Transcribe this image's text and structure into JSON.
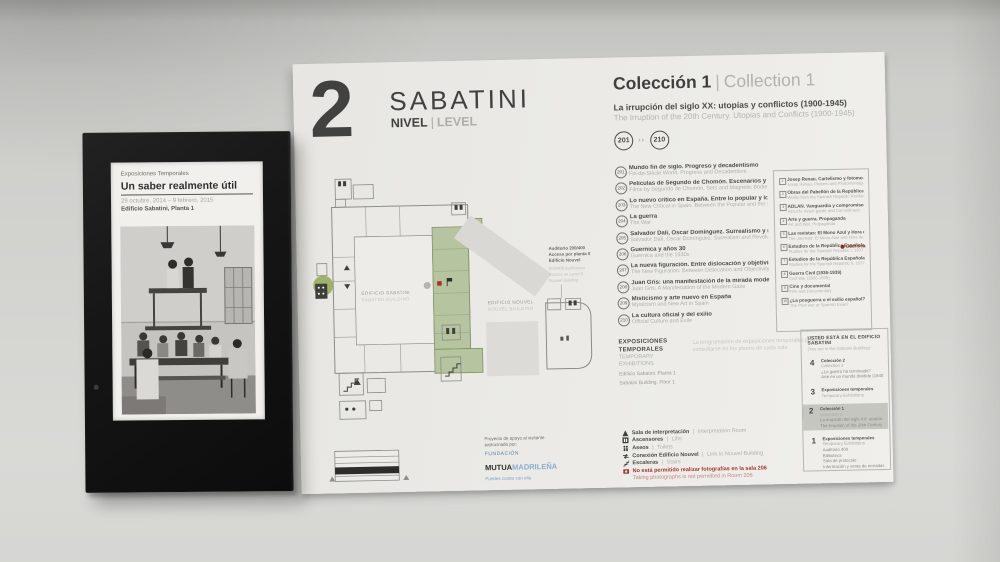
{
  "kiosk": {
    "eyebrow": "Exposiciones Temporales",
    "title": "Un saber realmente útil",
    "dates": "29 octubre, 2014 – 9 febrero, 2015",
    "location": "Edificio Sabatini, Planta 1"
  },
  "header": {
    "level_number": "2",
    "building_name": "SABATINI",
    "level_es": "NIVEL",
    "divider": "|",
    "level_en": "LEVEL"
  },
  "collection": {
    "title_es": "Colección 1",
    "divider": "|",
    "title_en": "Collection 1",
    "subtitle_es": "La irrupción del siglo XX: utopías y conflictos (1900-1945)",
    "subtitle_en": "The Irruption of the 20th Century. Utopias and Conflicts (1900-1945)",
    "room_start": "201",
    "room_end": "210",
    "range_separator": "››"
  },
  "rooms": [
    {
      "num": "201",
      "es": "Mundo fin de siglo. Progreso y decadentismo",
      "en": "Fin-de-Siècle World. Progress and Decadentism"
    },
    {
      "num": "202",
      "es": "Películas de Segundo de Chomón. Escenarios y cuerpos magnéticos",
      "en": "Films by Segundo de Chomón. Sets and Magnetic Bodies"
    },
    {
      "num": "203",
      "es": "Lo nuevo crítico en España. Entre lo popular y lo moderno",
      "en": "The New Critical in Spain. Between the Popular and the Modern"
    },
    {
      "num": "204",
      "es": "La guerra",
      "en": "The War"
    },
    {
      "num": "205",
      "es": "Salvador Dalí, Óscar Domínguez. Surrealismo y revolución",
      "en": "Salvador Dalí, Óscar Domínguez. Surrealism and Revolution"
    },
    {
      "num": "206",
      "es": "Guernica y años 30",
      "en": "Guernica and the 1930s"
    },
    {
      "num": "207",
      "es": "La nueva figuración. Entre dislocación y objetividad",
      "en": "The New Figuration. Between Dislocation and Objectivity"
    },
    {
      "num": "208",
      "es": "Juan Gris: una manifestación de la mirada moderna",
      "en": "Juan Gris: A Manifestation of the Modern Gaze"
    },
    {
      "num": "209",
      "es": "Misticismo y arte nuevo en España",
      "en": "Mysticism and New Art in Spain"
    },
    {
      "num": "210",
      "es": "La cultura oficial y del exilio",
      "en": "Official Culture and Exile"
    }
  ],
  "highlights": {
    "items": [
      {
        "num": "1",
        "es": "Josep Renau. Cartelismo y fotomontaje",
        "en": "Josep Renau. Posters and Photomontage"
      },
      {
        "num": "2",
        "es": "Obras del Pabellón de la República Española, 1937",
        "en": "Works from the Spanish Republic Pavilion, 1937"
      },
      {
        "num": "3",
        "es": "ADLAN. Vanguardia y compromiso",
        "en": "ADLAN. Avant-garde and Commitment"
      },
      {
        "num": "4",
        "es": "Arte y guerra. Propaganda",
        "en": "Art and War. Propaganda"
      },
      {
        "num": "5",
        "es": "Las revistas: El Mono Azul y Hora de España",
        "en": "The Journals: El Mono Azul and Hora de España"
      },
      {
        "num": "6",
        "es": "Estudios de la República Española I, 1937",
        "en": "Studies for the Spanish Republic I, 1937"
      },
      {
        "num": "7",
        "es": "Estudios de la República Española II, 1937",
        "en": "Studies for the Spanish Republic II, 1937"
      },
      {
        "num": "8",
        "es": "Guerra Civil (1936-1939)",
        "en": "Civil War (1936-1939)"
      },
      {
        "num": "9",
        "es": "Cine y documental",
        "en": "Film and Documentary"
      },
      {
        "num": "10",
        "es": "¿La posguerra o el exilio español?",
        "en": "The Post-war or Spanish Exile?"
      }
    ],
    "marker_label": "Guernica"
  },
  "map": {
    "sabatini_es": "EDIFICIO SABATINI",
    "sabatini_en": "SABATINI BUILDING",
    "nouvel_es": "EDIFICIO NOUVEL",
    "nouvel_en": "NOUVEL BUILDING",
    "aud_es_1": "Auditorio 200/400",
    "aud_es_2": "Acceso por planta 0",
    "aud_es_3": "Edificio Nouvel",
    "aud_en_1": "200/400 Auditorium",
    "aud_en_2": "Access on Level 0",
    "aud_en_3": "Nouvel Building"
  },
  "temporary": {
    "title_es": "EXPOSICIONES TEMPORALES",
    "title_en": "TEMPORARY EXHIBITIONS",
    "line1": "Edificio Sabatini. Planta 1",
    "line2": "Sabatini Building. Floor 1",
    "note1": "La programación de exposiciones temporales puede",
    "note2": "consultarse en los planos de cada sala"
  },
  "legend": {
    "items": [
      {
        "es": "Sala de interpretación",
        "sep": "|",
        "en": "Interpretation Room"
      },
      {
        "es": "Ascensores",
        "sep": "|",
        "en": "Lifts"
      },
      {
        "es": "Aseos",
        "sep": "|",
        "en": "Toilets"
      },
      {
        "es": "Conexión Edificio Nouvel",
        "sep": "|",
        "en": "Link to Nouvel Building"
      },
      {
        "es": "Escaleras",
        "sep": "|",
        "en": "Stairs"
      }
    ],
    "no_photo_es": "No está permitido realizar fotografías en la sala 206",
    "no_photo_en": "Taking photographs is not permitted in Room 206"
  },
  "directory": {
    "title": "USTED ESTÁ EN EL EDIFICIO SABATINI",
    "subtitle": "(You are in the Sabatini Building)",
    "levels": [
      {
        "num": "4",
        "lines": [
          "Colección 2",
          "Collection 2",
          "¿La guerra ha terminado?",
          "Arte en un mundo dividido (1945-1968)"
        ]
      },
      {
        "num": "3",
        "lines": [
          "Exposiciones temporales",
          "Temporary Exhibitions"
        ]
      },
      {
        "num": "2",
        "lines": [
          "Colección 1",
          "Collection 1",
          "La irrupción del siglo XX: utopías y conflictos",
          "The Irruption of the 20th Century"
        ]
      },
      {
        "num": "1",
        "lines": [
          "Exposiciones temporales",
          "Temporary Exhibitions",
          "Auditorio 400",
          "Biblioteca",
          "Sala de protocolo",
          "Información y venta de entradas"
        ]
      }
    ]
  },
  "sponsor": {
    "intro1": "Proyecto de apoyo al visitante",
    "intro2": "patrocinado por:",
    "fundacion": "FUNDACIÓN",
    "mutua": "MUTUA",
    "madrilena": "MADRILEÑA",
    "tagline": "Puedes contar con ella"
  },
  "colors": {
    "accent_green": "#b6c49f",
    "marker_red": "#a33227",
    "brand_blue": "#8aadd0",
    "highlight_gray": "#c6c6c1"
  }
}
